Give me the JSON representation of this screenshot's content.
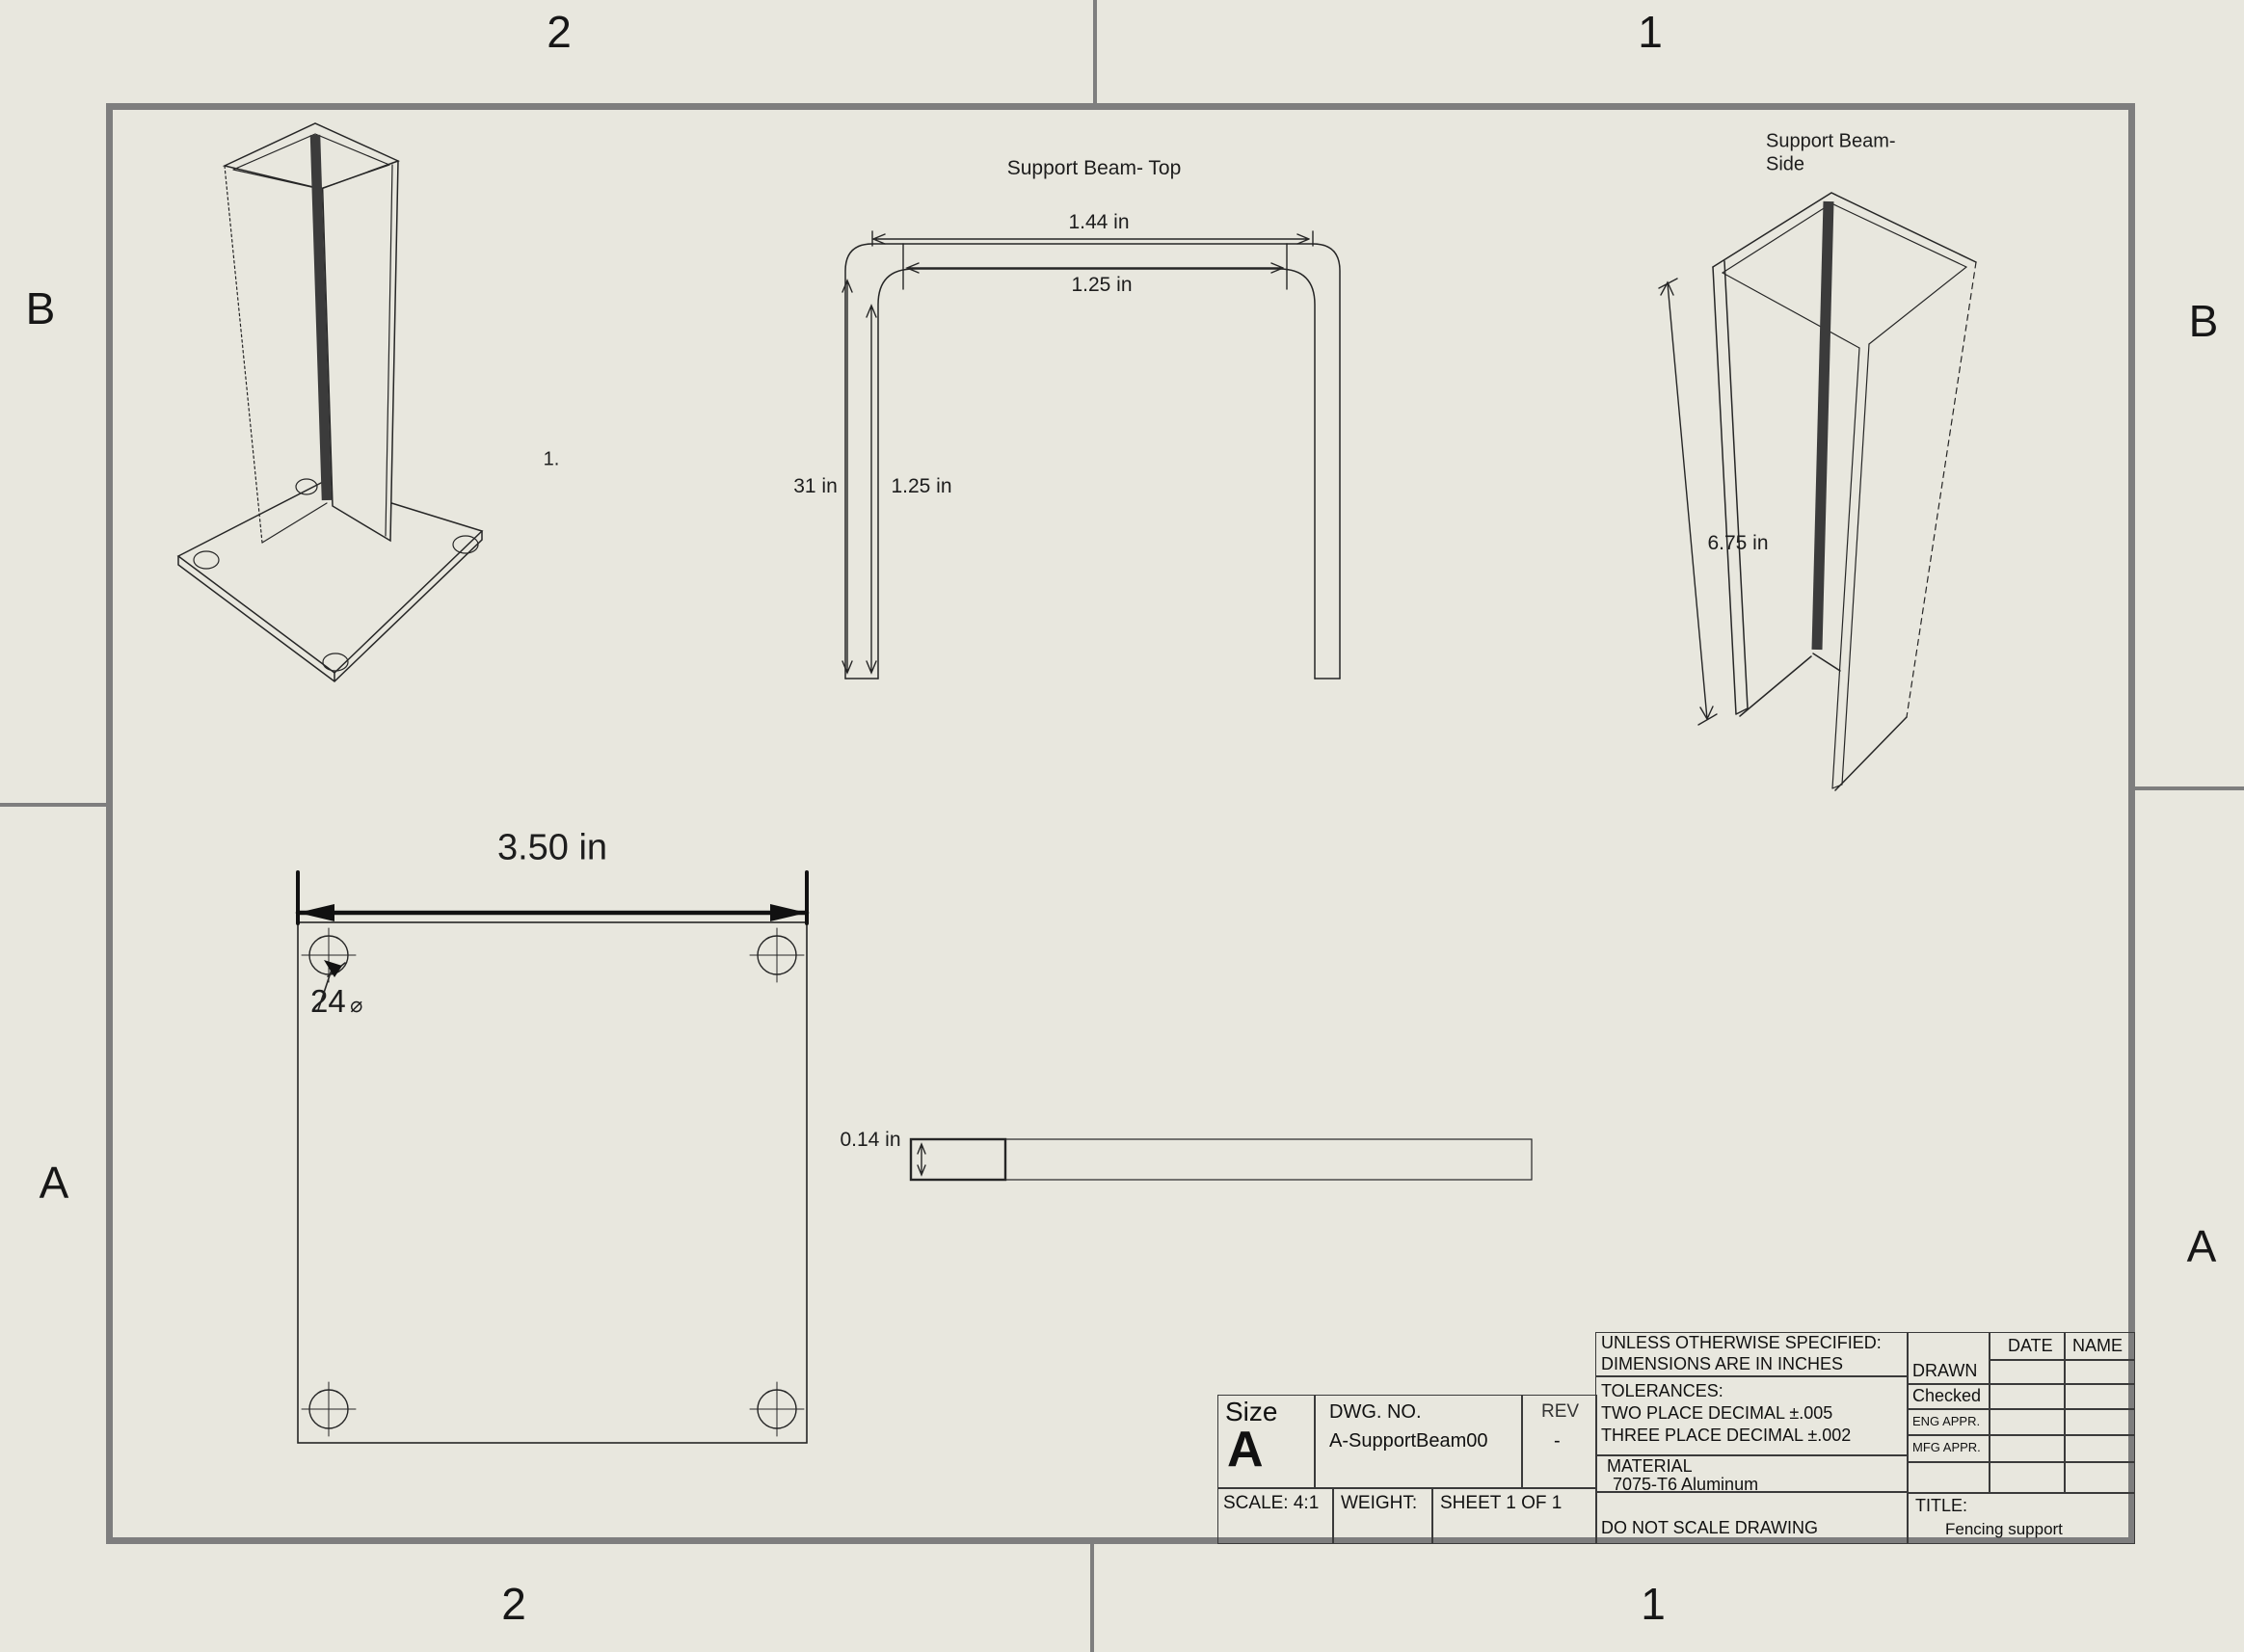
{
  "colors": {
    "background": "#e8e7de",
    "frame_gray": "#7e7e7e",
    "line_dark": "#262626"
  },
  "zones": {
    "top_left": "2",
    "top_right": "1",
    "bottom_left": "2",
    "bottom_right": "1",
    "left_upper": "B",
    "left_lower": "A",
    "right_upper": "B",
    "right_lower": "A"
  },
  "views": {
    "isometric": {
      "callout": "1."
    },
    "top_view": {
      "title": "Support Beam- Top",
      "dim_outer_width": "1.44 in",
      "dim_inner_width": "1.25 in",
      "dim_height": "31 in",
      "dim_inner_height": "1.25 in"
    },
    "side_view": {
      "title_line1": "Support Beam-",
      "title_line2": "Side",
      "dim_height": "6.75 in"
    },
    "base_plate_view": {
      "dim_width": "3.50 in",
      "hole_callout_value": "24",
      "hole_callout_symbol": "⌀"
    },
    "edge_view": {
      "dim_thickness": "0.14 in"
    }
  },
  "title_block": {
    "size_label": "Size",
    "size_value": "A",
    "dwg_label": "DWG. NO.",
    "dwg_value": "A-SupportBeam00",
    "rev_label": "REV",
    "rev_value": "-",
    "scale": "SCALE: 4:1",
    "weight": "WEIGHT:",
    "sheet": "SHEET 1 OF 1",
    "spec_line1": "UNLESS OTHERWISE SPECIFIED:",
    "spec_line2": "DIMENSIONS ARE IN INCHES",
    "tol_line1": "TOLERANCES:",
    "tol_line2": "TWO PLACE DECIMAL ±.005",
    "tol_line3": "THREE PLACE DECIMAL ±.002",
    "material_label": "MATERIAL",
    "material_value": "7075-T6 Aluminum",
    "do_not_scale": "DO NOT SCALE DRAWING",
    "approvals": {
      "date_header": "DATE",
      "name_header": "NAME",
      "rows": [
        "DRAWN",
        "Checked",
        "ENG APPR.",
        "MFG APPR."
      ]
    },
    "title_label": "TITLE:",
    "title_value": "Fencing support"
  }
}
